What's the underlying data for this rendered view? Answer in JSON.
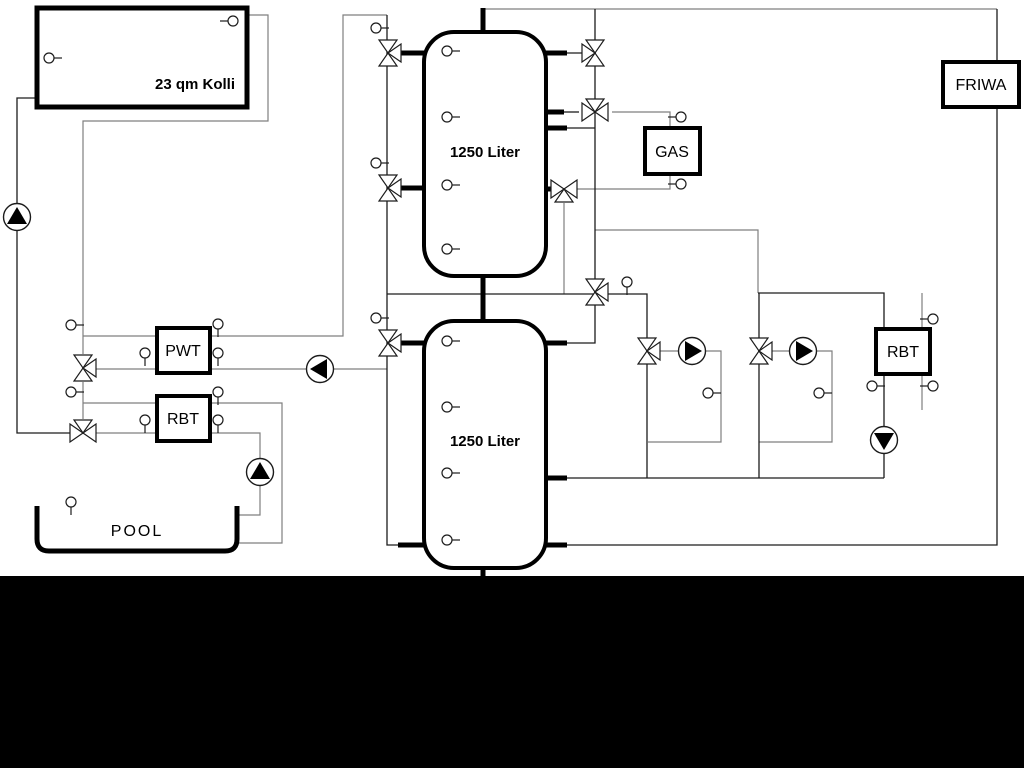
{
  "window": {
    "background": "#ffffff",
    "bottom_band_color": "#000000"
  },
  "diagram": {
    "components": {
      "collector": {
        "label": "23 qm Kolli"
      },
      "buffer_tank_upper": {
        "label": "1250 Liter"
      },
      "buffer_tank_lower": {
        "label": "1250 Liter"
      },
      "gas_boiler": {
        "label": "GAS"
      },
      "friwa_station": {
        "label": "FRIWA"
      },
      "pwt_heat_exchanger": {
        "label": "PWT"
      },
      "rbt_heat_exchanger_left": {
        "label": "RBT"
      },
      "rbt_heat_exchanger_right": {
        "label": "RBT"
      },
      "pool": {
        "label": "POOL"
      }
    },
    "colors": {
      "pipe_thick": "#000000",
      "line_dark": "#1c1c1c",
      "line_gray": "#7f7f7f"
    }
  }
}
